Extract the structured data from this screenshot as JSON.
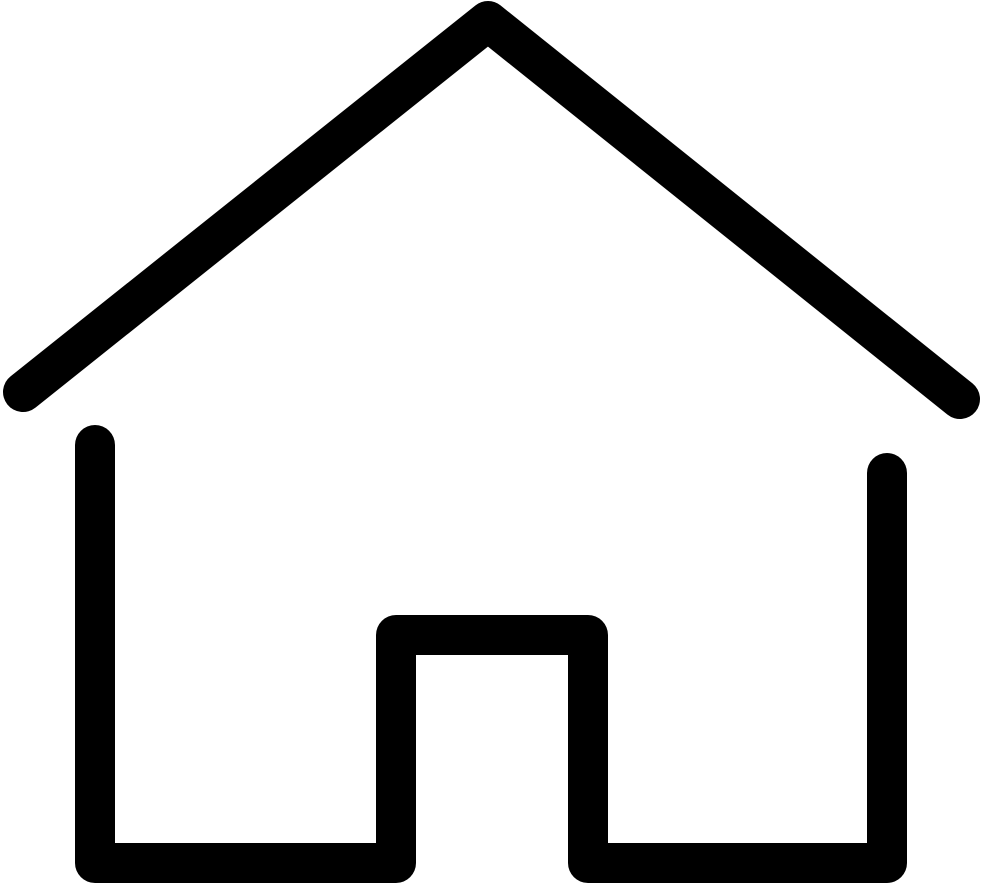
{
  "icon": {
    "name": "home-icon",
    "description": "Black outline house (home) pictogram with pitched roof, two walls, floor and centered door opening",
    "stroke_color": "#000000",
    "background_color": "#ffffff",
    "stroke_width": 40,
    "canvas": {
      "width": 982,
      "height": 886,
      "viewbox": "0 0 982 886"
    },
    "roof_path": "M23 392 L488 21 L960 399",
    "body_path": "M95 445 L95 863 L396 863 L396 635 L588 635 L588 863 L887 863 L887 473"
  }
}
